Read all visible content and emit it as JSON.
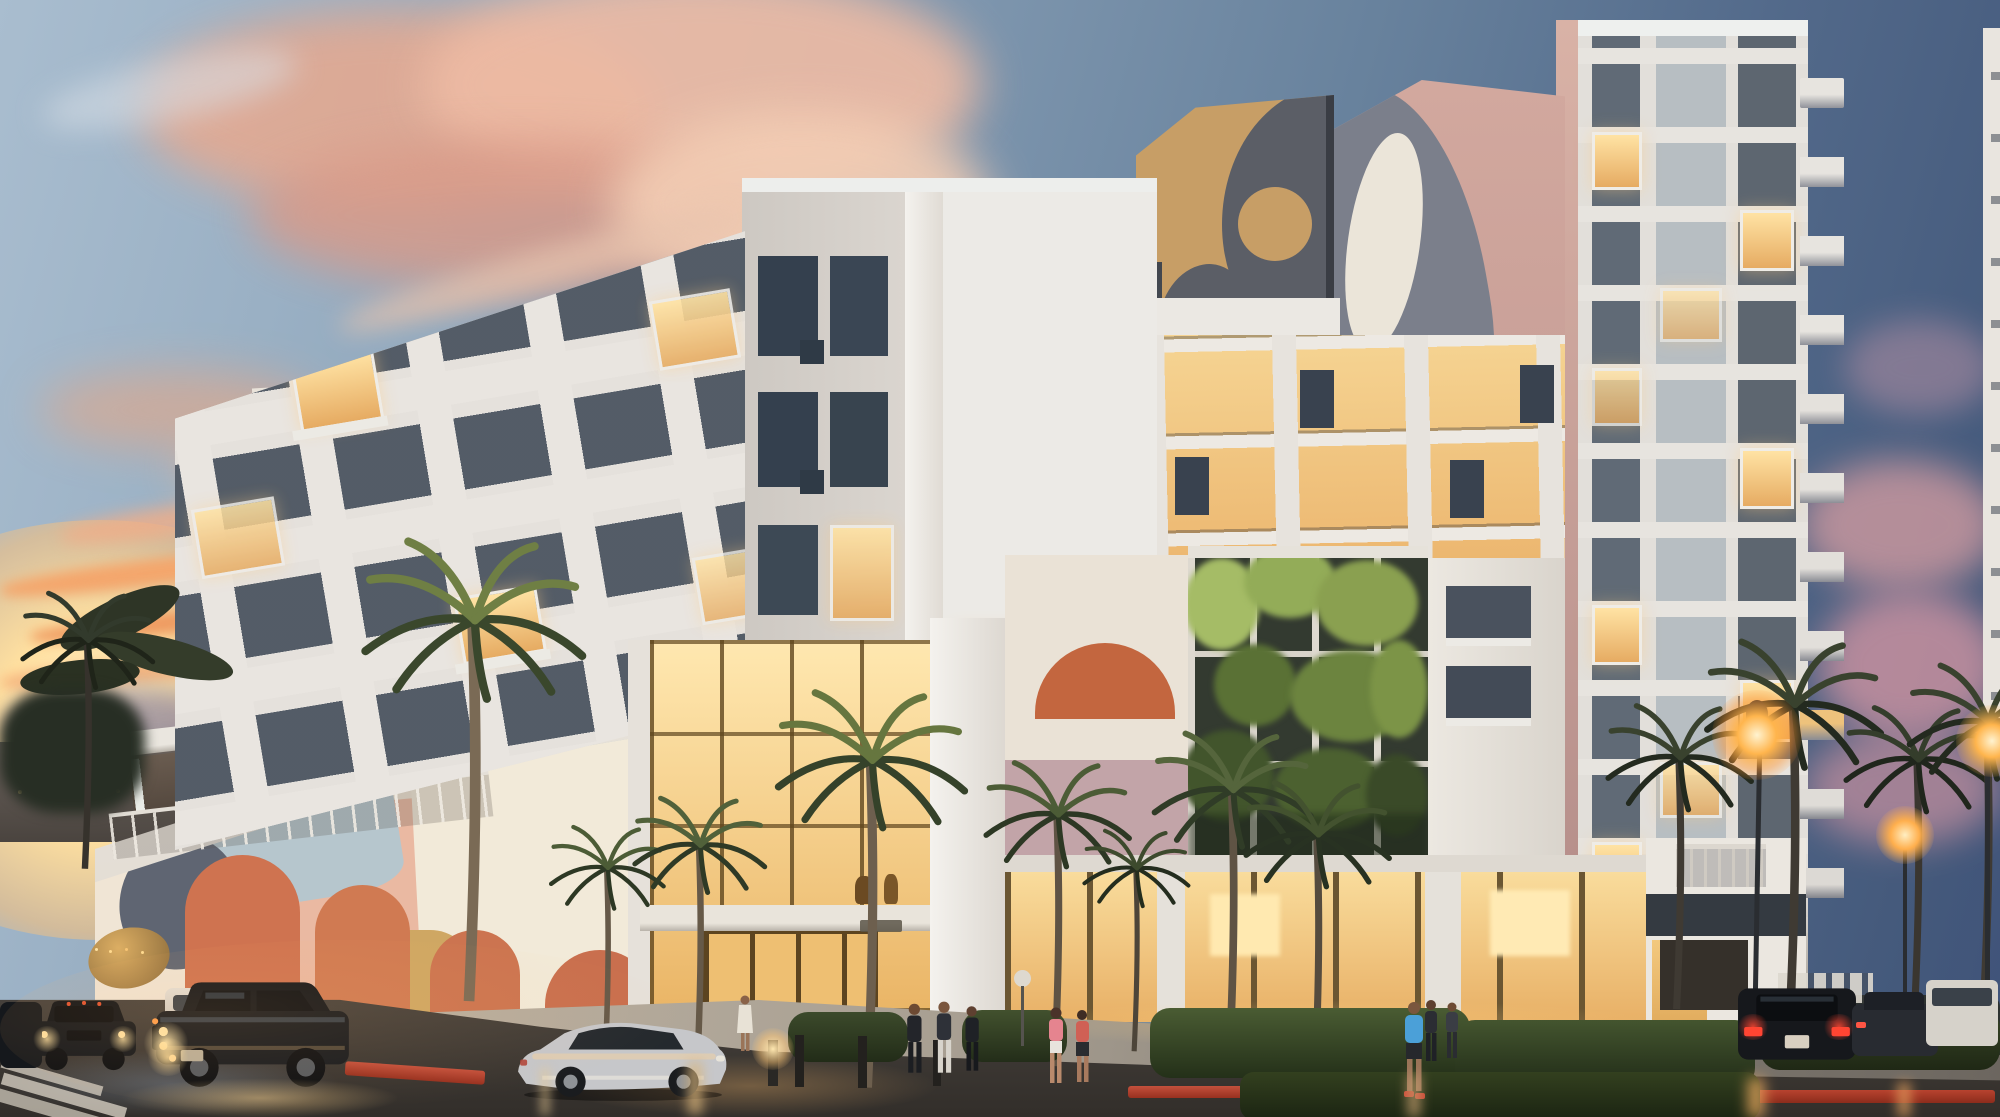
{
  "meta": {
    "description": "Dusk photograph of a pastel mixed-use building with abstract terrazzo murals, a white residential tower, palm trees, wet reflective streets, cars and pedestrians",
    "dimensions": {
      "width": 2000,
      "height": 1117
    }
  },
  "palette": {
    "sky_top_left": "#a9bdcf",
    "sky_right": "#3f527a",
    "sunset_glow": "#ffd99c",
    "cloud_pink": "#e8ab92",
    "cloud_cream": "#f3cdb4",
    "cloud_lavender": "#9a8f9d",
    "facade_white": "#e9e5e0",
    "facade_shadow": "#d6d2cd",
    "window_warm": "#f5cd86",
    "window_cool": "#3c4a5a",
    "mural_pink": "#cfa49b",
    "mural_gold": "#c79e66",
    "mural_slate": "#5f6572",
    "mural_blue": "#b6c6cd",
    "mural_salmon": "#eab9a2",
    "mural_terracotta": "#cf7350",
    "mural_cream": "#f0e5d5",
    "living_wall_green": "#7c9447",
    "road_wet": "#3a3531",
    "sidewalk": "#b3a999",
    "red_curb": "#b23a2c",
    "lamp_glow": "#ffb54d",
    "taillight_red": "#ff4433",
    "headlight_warm": "#ffe2a2"
  },
  "scene": {
    "sky": {
      "description": "Dusk sky: pale blue upper left fading to deep slate blue right, large pink sunset clouds center-left, bright orange glow and streak clouds at left horizon, lavender puffs low right"
    },
    "buildings": {
      "left_wing": {
        "description": "Five-storey white wing with balconies, scattered warm lit windows and a rooftop terrace with white columns and railing",
        "floors": 5
      },
      "podium": {
        "description": "Two-storey podium covered in a pastel abstract terrazzo mural: cream base with salmon blobs, terracotta arches, slate shapes, gold and pale blue patches"
      },
      "center_tower": {
        "description": "White corner tower with dark gridded windows, warm recessed balconies and a double-height glass lobby glowing at the corner"
      },
      "gold_block": {
        "description": "Gold terrazzo rooftop panel with a charcoal curved shape and a gold circle"
      },
      "pink_mural_wall": {
        "description": "Tall salmon-pink terrazzo wall with slate grey, cream, khaki and coral organic shapes"
      },
      "living_wall": {
        "description": "Vertical garden with white grid frame, three rows of green planted bays",
        "rows": 3,
        "bays": 4
      },
      "right_tower": {
        "description": "Twelve-storey white residential tower, pink sunset-lit left edge, stacked side balconies, mix of warm lit and dark windows",
        "floors": 12
      },
      "low_right_building": {
        "description": "Small white building with dark fascia band down the cross street"
      }
    },
    "street": {
      "description": "Wet reflective asphalt intersection, light paver sidewalk, red painted curbs, crosswalk stripes lower left, glowing shopfronts",
      "features": [
        "crosswalk",
        "red_curb",
        "hedges",
        "bollards",
        "street_lamps",
        "gold_umbrella"
      ]
    },
    "vehicles": [
      {
        "type": "suv",
        "color": "black",
        "state": "driving, headlights on",
        "position": "left foreground"
      },
      {
        "type": "suv",
        "color": "dark grey",
        "state": "following",
        "position": "far left"
      },
      {
        "type": "van",
        "color": "white",
        "state": "parked",
        "position": "behind left suv"
      },
      {
        "type": "sedan",
        "color": "silver",
        "state": "parked at curb",
        "position": "center left"
      },
      {
        "type": "suv",
        "color": "black",
        "state": "taillights lit",
        "position": "right street"
      },
      {
        "type": "sedan",
        "color": "dark grey",
        "state": "parked",
        "position": "far right"
      },
      {
        "type": "minibus",
        "color": "white",
        "state": "parked",
        "position": "far right edge"
      }
    ],
    "people": [
      {
        "group": "three pedestrians in dark clothes",
        "position": "near lobby entrance"
      },
      {
        "group": "two women walking, pink and red tops",
        "position": "center sidewalk"
      },
      {
        "group": "man in blue t-shirt and red shoes",
        "position": "right sidewalk"
      },
      {
        "group": "couple walking",
        "position": "right of blue-shirt man"
      },
      {
        "group": "figure in white",
        "position": "beside silver sedan"
      }
    ],
    "vegetation": {
      "palms": 13,
      "hedges": 6,
      "description": "Sabal palms along both frontages, dark silhouette palms at far left and right, trimmed hedges along shopfronts"
    },
    "lighting": {
      "description": "Dusk ambience: warm interior glow from lobby and shopfronts, orange street lamps, headlight and lamp reflections streaking on wet road"
    }
  }
}
